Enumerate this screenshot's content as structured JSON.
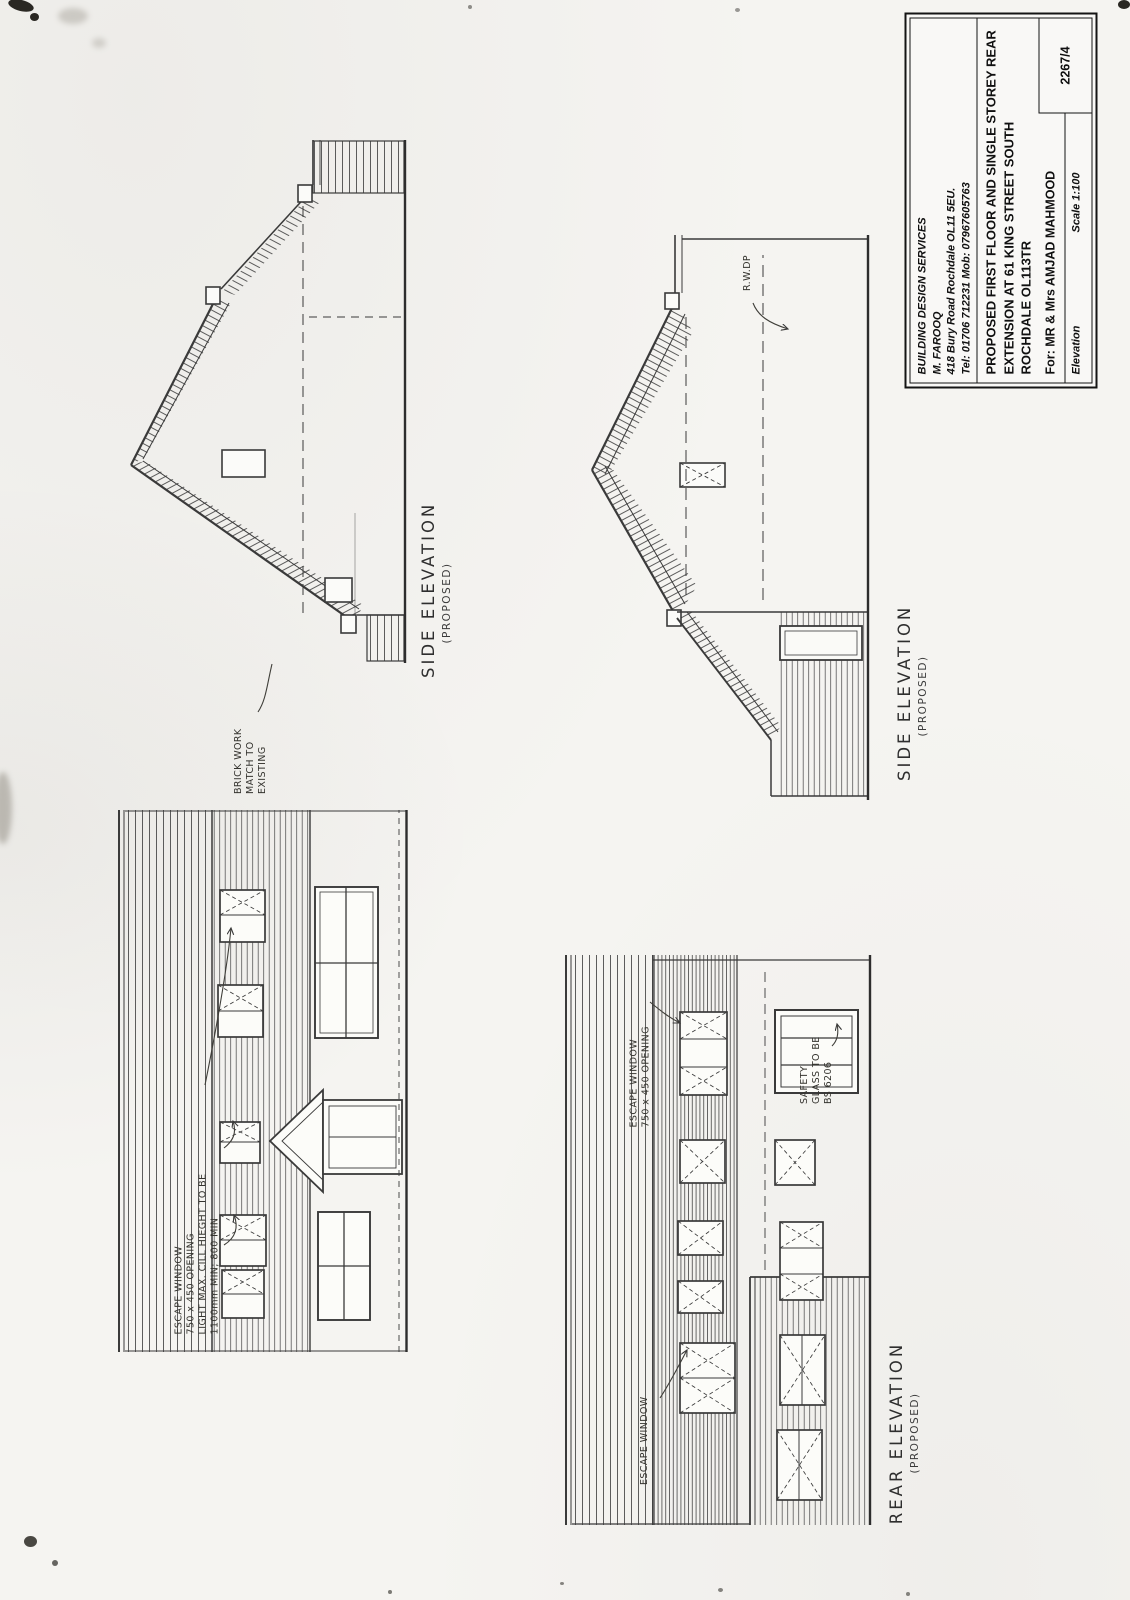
{
  "page": {
    "paper_color": "#f5f4f1",
    "ink_color": "#2b2b2b",
    "hatch_color": "#4a4a4a"
  },
  "title_block": {
    "company": "BUILDING DESIGN SERVICES",
    "author": "M. FAROOQ",
    "address": "418 Bury Road Rochdale OL11 5EU.",
    "phone": "Tel: 01706 712231 Mob: 07967605763",
    "project_lines": [
      "PROPOSED FIRST FLOOR AND SINGLE STOREY REAR",
      "EXTENSION AT 61 KING STREET SOUTH",
      "ROCHDALE OL113TR"
    ],
    "client": "For: MR & Mrs AMJAD MAHMOOD",
    "sheet_type": "Elevation",
    "scale": "Scale 1:100",
    "drawing_number": "2267/4"
  },
  "labels": {
    "side_elevation_1": {
      "title": "SIDE ELEVATION",
      "subtitle": "(PROPOSED)"
    },
    "side_elevation_2": {
      "title": "SIDE ELEVATION",
      "subtitle": "(PROPOSED)"
    },
    "rear_elevation": {
      "title": "REAR ELEVATION",
      "subtitle": "(PROPOSED)"
    }
  },
  "notes": {
    "brick": [
      "BRICK WORK",
      "MATCH TO",
      "EXISTING"
    ],
    "escape_full": [
      "ESCAPE WINDOW",
      "750 x 450 OPENING",
      "LIGHT MAX. CILL HIEGHT TO BE",
      "1100mm MIN; 800 MIN"
    ],
    "escape_short": [
      "ESCAPE WINDOW",
      "750 x 450 OPENING"
    ],
    "escape_single": "ESCAPE WINDOW",
    "safety": [
      "SAFETY",
      "GLASS TO BE",
      "BS 6206"
    ],
    "rwdp": "R.W.DP"
  }
}
